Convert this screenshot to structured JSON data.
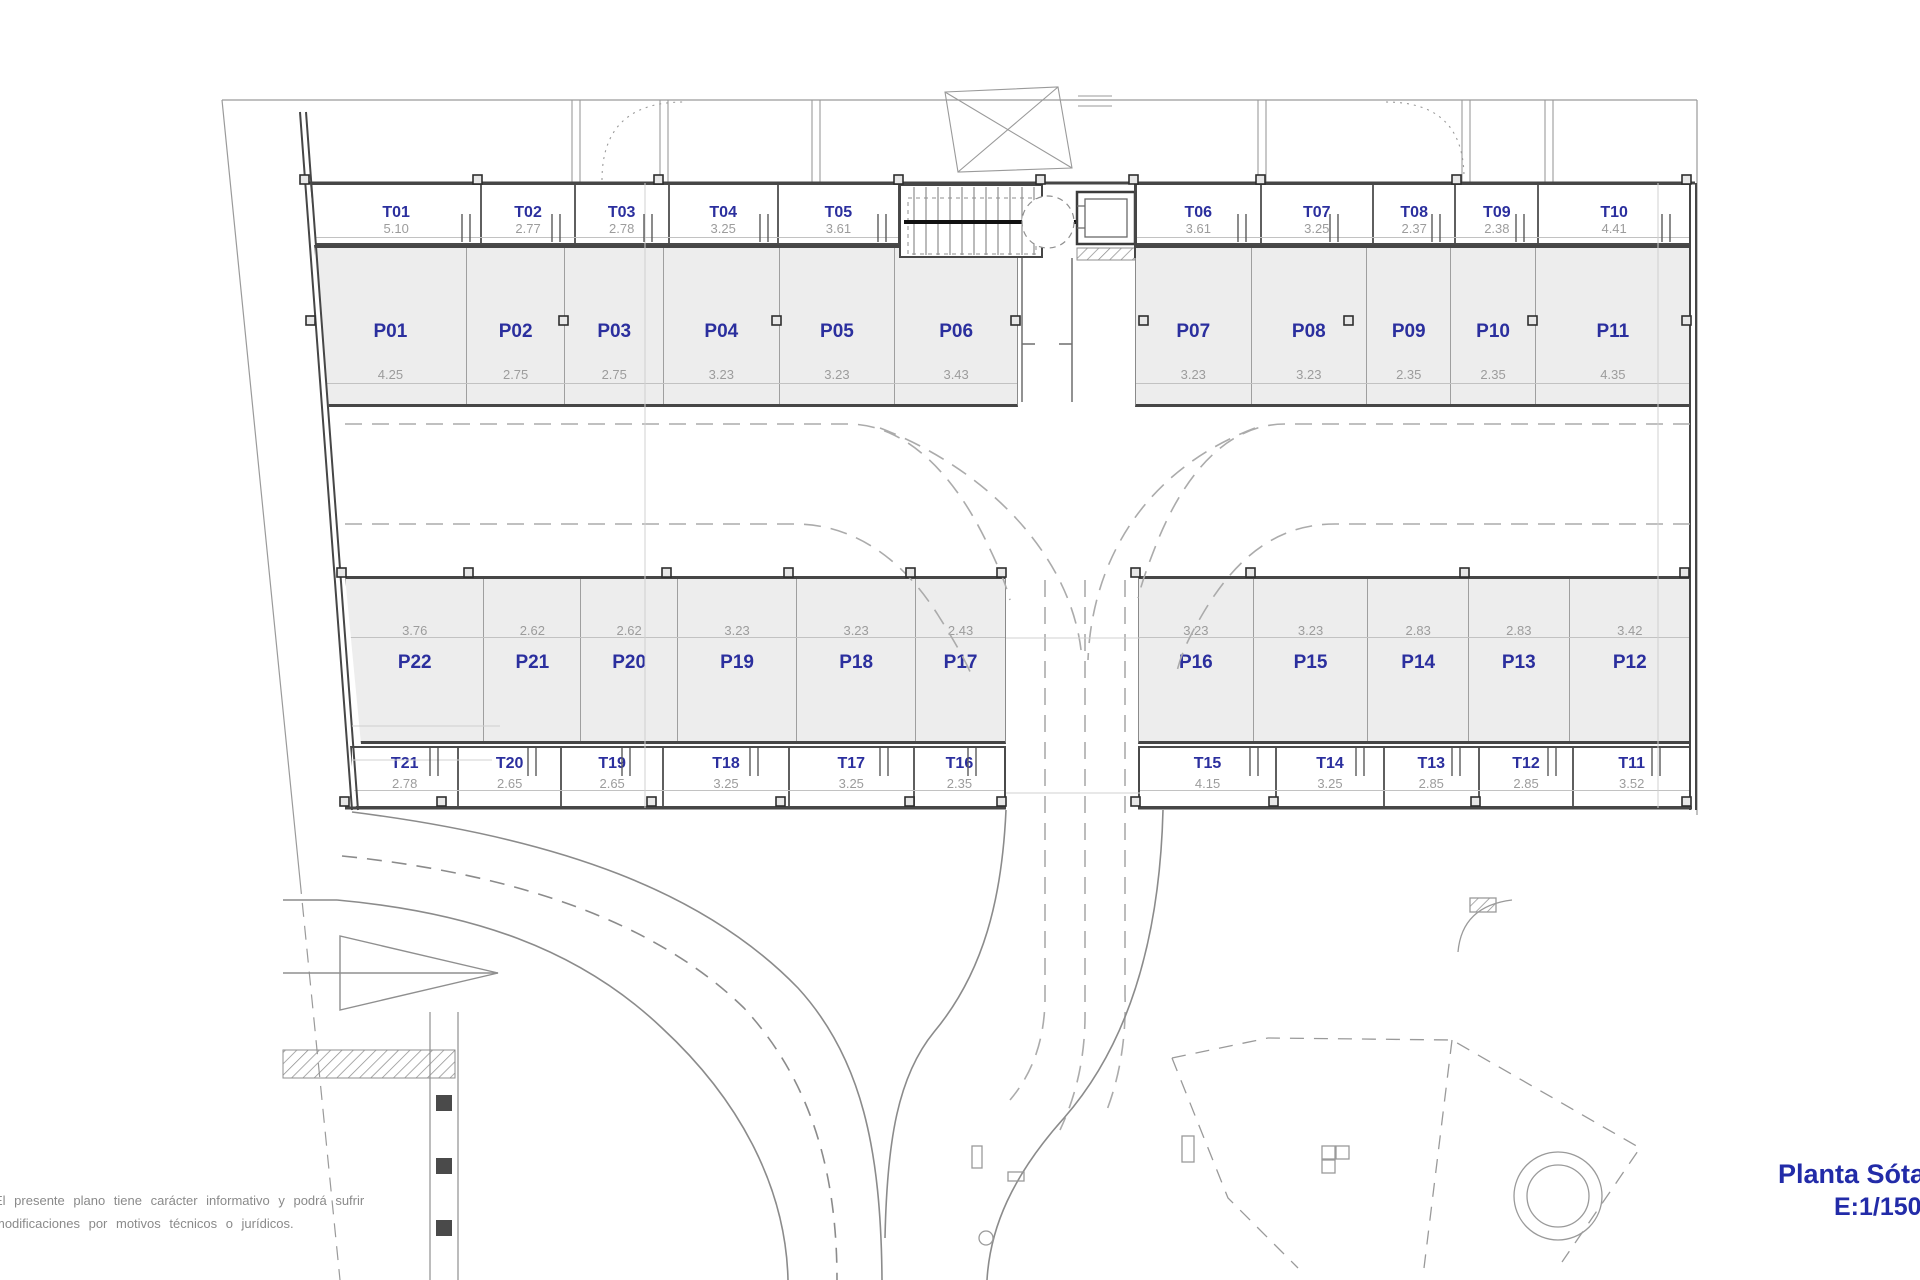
{
  "title_block": {
    "line1": "Planta Sótano",
    "line2": "E:1/150",
    "color": "#222ba8"
  },
  "disclaimer": {
    "line1": "El presente plano tiene carácter informativo y podrá sufrir",
    "line2": "modificaciones por motivos técnicos o jurídicos."
  },
  "colors": {
    "parking_fill": "#ededed",
    "wall": "#464646",
    "thin_line": "#8b8b8b",
    "label_blue": "#2b2f9e",
    "dim_gray": "#9c9c9c",
    "title_blue": "#222ba8"
  },
  "units": {
    "top_left_storage": [
      {
        "id": "T01",
        "dim": "5.10"
      },
      {
        "id": "T02",
        "dim": "2.77"
      },
      {
        "id": "T03",
        "dim": "2.78"
      },
      {
        "id": "T04",
        "dim": "3.25"
      },
      {
        "id": "T05",
        "dim": "3.61"
      }
    ],
    "top_right_storage": [
      {
        "id": "T06",
        "dim": "3.61"
      },
      {
        "id": "T07",
        "dim": "3.25"
      },
      {
        "id": "T08",
        "dim": "2.37"
      },
      {
        "id": "T09",
        "dim": "2.38"
      },
      {
        "id": "T10",
        "dim": "4.41"
      }
    ],
    "top_left_parking": [
      {
        "id": "P01",
        "dim": "4.25"
      },
      {
        "id": "P02",
        "dim": "2.75"
      },
      {
        "id": "P03",
        "dim": "2.75"
      },
      {
        "id": "P04",
        "dim": "3.23"
      },
      {
        "id": "P05",
        "dim": "3.23"
      },
      {
        "id": "P06",
        "dim": "3.43"
      }
    ],
    "top_right_parking": [
      {
        "id": "P07",
        "dim": "3.23"
      },
      {
        "id": "P08",
        "dim": "3.23"
      },
      {
        "id": "P09",
        "dim": "2.35"
      },
      {
        "id": "P10",
        "dim": "2.35"
      },
      {
        "id": "P11",
        "dim": "4.35"
      }
    ],
    "bottom_left_parking": [
      {
        "id": "P22",
        "dim": "3.76"
      },
      {
        "id": "P21",
        "dim": "2.62"
      },
      {
        "id": "P20",
        "dim": "2.62"
      },
      {
        "id": "P19",
        "dim": "3.23"
      },
      {
        "id": "P18",
        "dim": "3.23"
      },
      {
        "id": "P17",
        "dim": "2.43"
      }
    ],
    "bottom_right_parking": [
      {
        "id": "P16",
        "dim": "3.23"
      },
      {
        "id": "P15",
        "dim": "3.23"
      },
      {
        "id": "P14",
        "dim": "2.83"
      },
      {
        "id": "P13",
        "dim": "2.83"
      },
      {
        "id": "P12",
        "dim": "3.42"
      }
    ],
    "bottom_left_storage": [
      {
        "id": "T21",
        "dim": "2.78"
      },
      {
        "id": "T20",
        "dim": "2.65"
      },
      {
        "id": "T19",
        "dim": "2.65"
      },
      {
        "id": "T18",
        "dim": "3.25"
      },
      {
        "id": "T17",
        "dim": "3.25"
      },
      {
        "id": "T16",
        "dim": "2.35"
      }
    ],
    "bottom_right_storage": [
      {
        "id": "T15",
        "dim": "4.15"
      },
      {
        "id": "T14",
        "dim": "3.25"
      },
      {
        "id": "T13",
        "dim": "2.85"
      },
      {
        "id": "T12",
        "dim": "2.85"
      },
      {
        "id": "T11",
        "dim": "3.52"
      }
    ]
  },
  "vdims": [
    {
      "t": "1.60",
      "x": 628,
      "y": 186
    },
    {
      "t": "5.00",
      "x": 628,
      "y": 290
    },
    {
      "t": "1.60",
      "x": 1650,
      "y": 186
    },
    {
      "t": "5.00",
      "x": 1650,
      "y": 290
    },
    {
      "t": "5.00",
      "x": 638,
      "y": 460
    },
    {
      "t": "5.00",
      "x": 1678,
      "y": 460
    },
    {
      "t": "5.00",
      "x": 654,
      "y": 628
    },
    {
      "t": "5.00",
      "x": 1648,
      "y": 628
    },
    {
      "t": "1.80",
      "x": 646,
      "y": 740
    },
    {
      "t": "1.80",
      "x": 1642,
      "y": 740
    },
    {
      "t": "4.00",
      "x": 430,
      "y": 940
    }
  ],
  "hdims": [
    {
      "t": "4.82",
      "x": 1053,
      "y": 588
    },
    {
      "t": "4.00",
      "x": 1048,
      "y": 770
    },
    {
      "t": "2.98",
      "x": 428,
      "y": 698
    },
    {
      "t": "3.04",
      "x": 432,
      "y": 736
    }
  ]
}
